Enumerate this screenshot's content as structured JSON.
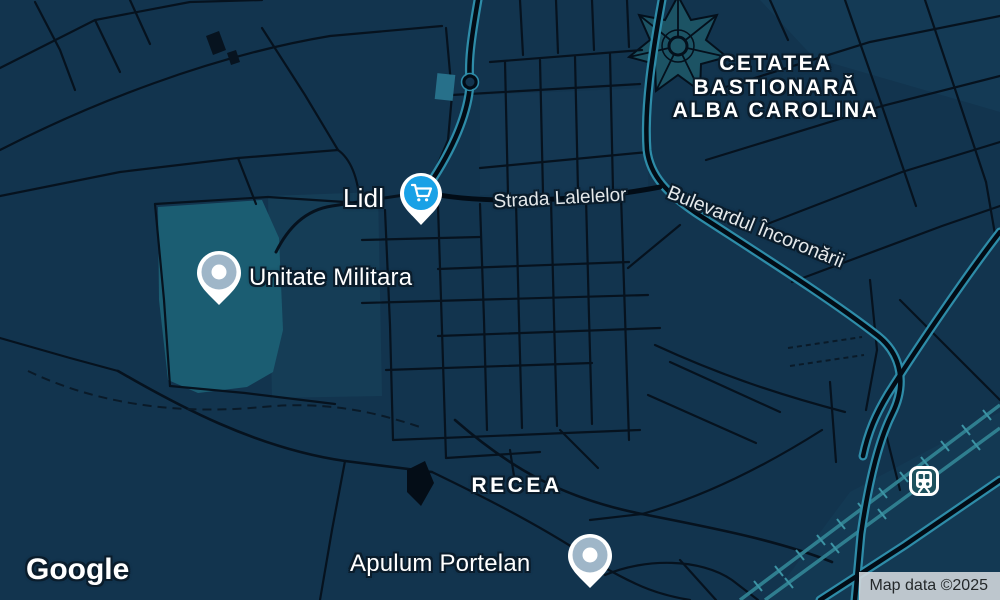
{
  "map": {
    "brand": "Google",
    "attribution_text": "Map data ©2025",
    "style": "dark-navy-night"
  },
  "labels": {
    "citadel": {
      "line1": "CETATEA",
      "line2": "BASTIONARĂ",
      "line3": "ALBA CAROLINA"
    },
    "locality_recea": "RECEA",
    "street_lalelelor": "Strada Lalelelor",
    "street_incoronarii": "Bulevardul Încoronării"
  },
  "pois": {
    "lidl": {
      "name": "Lidl",
      "icon": "shopping-cart-icon",
      "pin_color": "#19A1E6"
    },
    "unitate_militara": {
      "name": "Unitate Militara",
      "icon": "poi-pin-icon",
      "pin_color": "#9FB6C8"
    },
    "apulum_portelan": {
      "name": "Apulum Portelan",
      "icon": "poi-pin-icon",
      "pin_color": "#9FB6C8"
    },
    "train_station": {
      "icon": "train-station-icon",
      "chip_color": "#1D525E"
    }
  },
  "colors": {
    "background": "#12344E",
    "road_minor": "#06121E",
    "road_major_core": "#020C16",
    "road_major_casing": "#2E8CA8",
    "railway": "#2F7E8F",
    "railway_ties": "#3C93A4",
    "water_military_area": "#1B5D72",
    "citadel_area": "#1C5364",
    "label_text": "#FFFFFF",
    "label_outline": "#0A1C2B",
    "attribution_bg": "#D0D6DA",
    "attribution_text": "#24282A"
  }
}
